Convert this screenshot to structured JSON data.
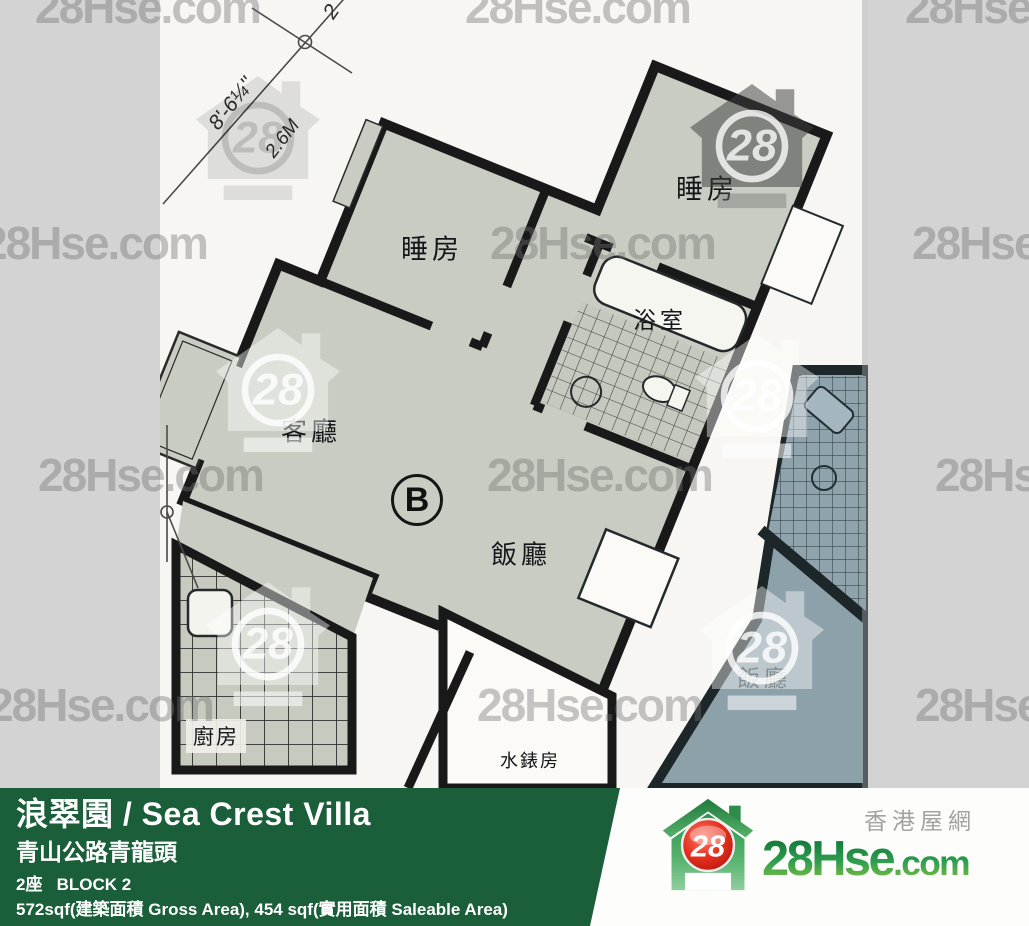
{
  "watermark": {
    "text": "28Hse.com",
    "badge": "28"
  },
  "plan": {
    "unit_label": "B",
    "rooms": {
      "bedroom_top": {
        "label": "睡房"
      },
      "bedroom_right": {
        "label": "睡房"
      },
      "bathroom": {
        "label": "浴室"
      },
      "living_room": {
        "label": "客廳"
      },
      "dining_room": {
        "label": "飯廳"
      },
      "kitchen": {
        "label": "廚房"
      },
      "water_meter_room": {
        "label": "水錶房"
      },
      "adjacent_dining": {
        "label": "飯廳"
      }
    },
    "dimensions": {
      "width_ft": "8'-6¼''",
      "width_m": "2.6M",
      "partial": "2"
    }
  },
  "footer": {
    "estate_name": "浪翠園 / Sea Crest Villa",
    "address": "青山公路青龍頭",
    "block": "2座   BLOCK 2",
    "areas": "572sqf(建築面積 Gross Area), 454 sqf(實用面積 Saleable Area)"
  },
  "logo": {
    "brand": "28Hse",
    "suffix": ".com",
    "badge": "28",
    "tagline": "香港屋網"
  },
  "colors": {
    "footer_green": "#1a5e3a",
    "floor_gray": "#c8ccc2",
    "floor_blue": "#8da1ab",
    "wall": "#191919",
    "matte_gray": "#d3d3d3"
  }
}
